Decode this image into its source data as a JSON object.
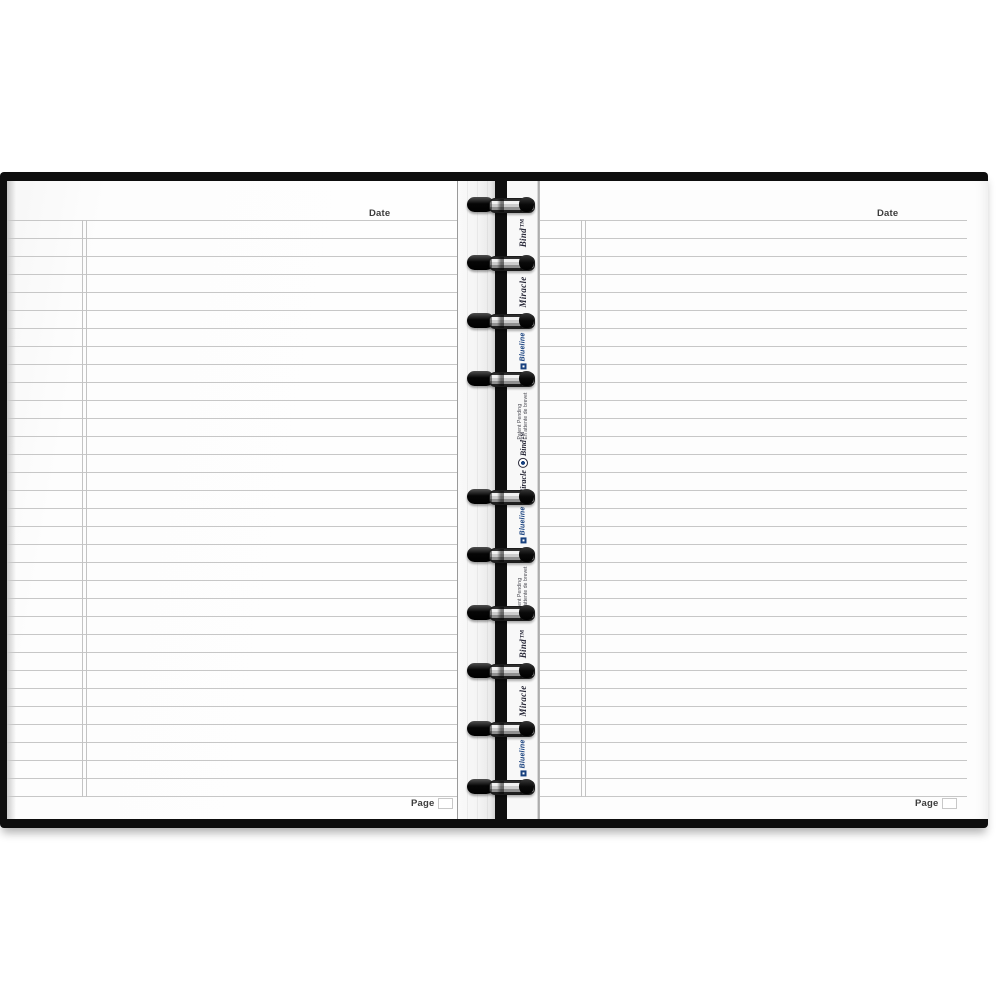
{
  "colors": {
    "cover_black": "#0e0e0e",
    "page_white": "#fdfdfd",
    "rule_line_gray": "#c7c7c7",
    "blueline_brand_blue": "#17407e",
    "ink_dark": "#3c3c3c"
  },
  "left_page": {
    "date_label": "Date",
    "page_label": "Page"
  },
  "right_page": {
    "date_label": "Date",
    "page_label": "Page"
  },
  "spine": {
    "ring_ys": [
      205,
      263,
      321,
      379,
      497,
      555,
      613,
      671,
      729,
      787
    ],
    "items": [
      {
        "kind": "script",
        "text": "Bind™",
        "y": 233
      },
      {
        "kind": "script",
        "text": "Miracle",
        "y": 292
      },
      {
        "kind": "blueline",
        "text": "Blueline",
        "y": 351
      },
      {
        "kind": "patent",
        "line1": "Patent Pending",
        "line2": "En attente de brevet",
        "y": 416
      },
      {
        "kind": "brand",
        "text_a": "Miracle",
        "text_b": "Bind™",
        "y": 464
      },
      {
        "kind": "blueline",
        "text": "Blueline",
        "y": 525
      },
      {
        "kind": "patent",
        "line1": "Patent Pending",
        "line2": "En attente de brevet",
        "y": 590
      },
      {
        "kind": "script",
        "text": "Bind™",
        "y": 644
      },
      {
        "kind": "script",
        "text": "Miracle",
        "y": 701
      },
      {
        "kind": "blueline",
        "text": "Blueline",
        "y": 758
      }
    ]
  }
}
